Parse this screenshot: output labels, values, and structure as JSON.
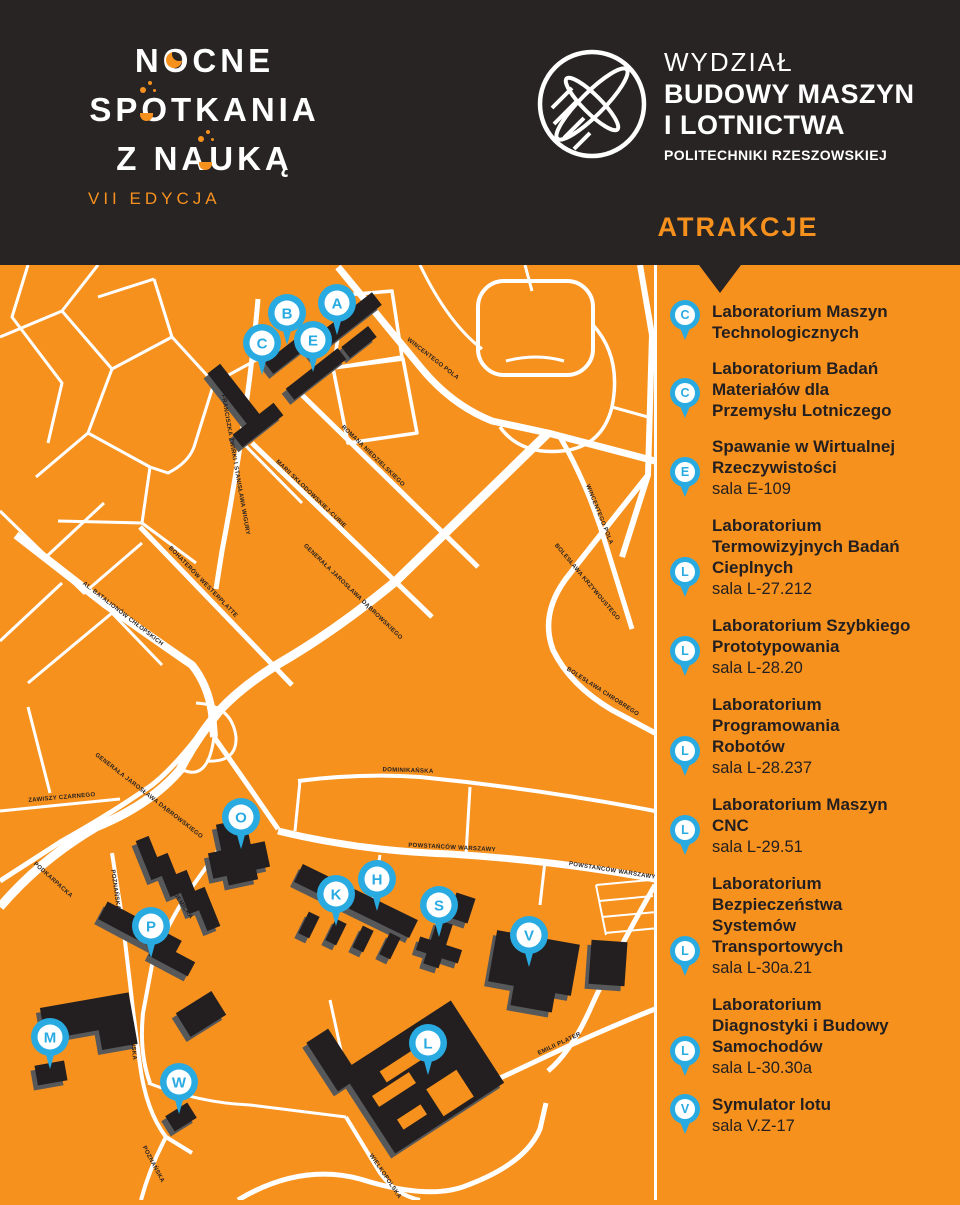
{
  "colors": {
    "orange": "#F6911E",
    "dark": "#282424",
    "ink": "#231F20",
    "blue": "#29ABE2",
    "white": "#FFFFFF",
    "building_shadow": "#57585A"
  },
  "brand": {
    "line1": "NOCNE",
    "line2": "SPOTKANIA",
    "line3": "Z NAUKĄ",
    "edition": "VII EDYCJA"
  },
  "faculty": {
    "line1": "WYDZIAŁ",
    "line2": "BUDOWY MASZYN",
    "line3": "I LOTNICTWA",
    "line4": "POLITECHNIKI RZESZOWSKIEJ"
  },
  "attractions_heading": "ATRAKCJE",
  "attractions": [
    {
      "letter": "C",
      "title": "Laboratorium Maszyn\nTechnologicznych",
      "room": ""
    },
    {
      "letter": "C",
      "title": "Laboratorium Badań\nMateriałów dla\nPrzemysłu Lotniczego",
      "room": ""
    },
    {
      "letter": "E",
      "title": "Spawanie w Wirtualnej\nRzeczywistości",
      "room": "sala E-109"
    },
    {
      "letter": "L",
      "title": "Laboratorium\nTermowizyjnych Badań\nCieplnych",
      "room": "sala L-27.212"
    },
    {
      "letter": "L",
      "title": "Laboratorium Szybkiego\nPrototypowania",
      "room": "sala L-28.20"
    },
    {
      "letter": "L",
      "title": "Laboratorium\nProgramowania\nRobotów",
      "room": "sala L-28.237"
    },
    {
      "letter": "L",
      "title": "Laboratorium Maszyn\nCNC",
      "room": "sala L-29.51"
    },
    {
      "letter": "L",
      "title": "Laboratorium\nBezpieczeństwa\nSystemów\nTransportowych",
      "room": "sala L-30a.21"
    },
    {
      "letter": "L",
      "title": "Laboratorium\nDiagnostyki i Budowy\nSamochodów",
      "room": "sala L-30.30a"
    },
    {
      "letter": "V",
      "title": "Symulator lotu",
      "room": "sala V.Z-17"
    }
  ],
  "map": {
    "pins": [
      {
        "letter": "A",
        "x": 337,
        "y": 38
      },
      {
        "letter": "B",
        "x": 287,
        "y": 48
      },
      {
        "letter": "E",
        "x": 313,
        "y": 75
      },
      {
        "letter": "C",
        "x": 262,
        "y": 78
      },
      {
        "letter": "O",
        "x": 241,
        "y": 552
      },
      {
        "letter": "H",
        "x": 377,
        "y": 614
      },
      {
        "letter": "K",
        "x": 336,
        "y": 629
      },
      {
        "letter": "S",
        "x": 439,
        "y": 640
      },
      {
        "letter": "P",
        "x": 151,
        "y": 661
      },
      {
        "letter": "V",
        "x": 529,
        "y": 670
      },
      {
        "letter": "M",
        "x": 50,
        "y": 772
      },
      {
        "letter": "L",
        "x": 428,
        "y": 778
      },
      {
        "letter": "W",
        "x": 179,
        "y": 817
      }
    ],
    "street_labels": [
      {
        "text": "WINCENTEGO POLA",
        "x": 432,
        "y": 95,
        "rot": 38
      },
      {
        "text": "WINCENTEGO POLA",
        "x": 598,
        "y": 250,
        "rot": 68
      },
      {
        "text": "ROMANA NIEDZIELSKIEGO",
        "x": 372,
        "y": 192,
        "rot": 44
      },
      {
        "text": "FRANCISZKA ŻWIRKI I STANISŁAWA WIGURY",
        "x": 234,
        "y": 200,
        "rot": 80
      },
      {
        "text": "MARII SKŁODOWSKIEJ-CURIE",
        "x": 310,
        "y": 230,
        "rot": 44
      },
      {
        "text": "GENERAŁA JAROSŁAWA DĄBROWSKIEGO",
        "x": 352,
        "y": 328,
        "rot": 44
      },
      {
        "text": "GENERAŁA JAROSŁAWA DĄBROWSKIEGO",
        "x": 148,
        "y": 532,
        "rot": 38
      },
      {
        "text": "AL. BATALIONÓW CHŁOPSKICH",
        "x": 122,
        "y": 350,
        "rot": 38
      },
      {
        "text": "BOHATERÓW WESTERPLATTE",
        "x": 202,
        "y": 318,
        "rot": 46
      },
      {
        "text": "BOLESŁAWA KRZYWOUSTEGO",
        "x": 586,
        "y": 318,
        "rot": 50
      },
      {
        "text": "BOLESŁAWA CHROBREGO",
        "x": 602,
        "y": 428,
        "rot": 33
      },
      {
        "text": "ZAWISZY CZARNEGO",
        "x": 62,
        "y": 534,
        "rot": -5
      },
      {
        "text": "PODKARPACKA",
        "x": 52,
        "y": 616,
        "rot": 42
      },
      {
        "text": "POZNAŃSKA",
        "x": 114,
        "y": 625,
        "rot": 82
      },
      {
        "text": "POZNAŃSKA",
        "x": 131,
        "y": 775,
        "rot": 84
      },
      {
        "text": "POZNAŃSKA",
        "x": 152,
        "y": 900,
        "rot": 62
      },
      {
        "text": "AKADEMICKA",
        "x": 178,
        "y": 636,
        "rot": 56
      },
      {
        "text": "POWSTAŃCÓW WARSZAWY",
        "x": 452,
        "y": 584,
        "rot": 3
      },
      {
        "text": "POWSTAŃCÓW WARSZAWY",
        "x": 612,
        "y": 607,
        "rot": 9
      },
      {
        "text": "DOMINIKAŃSKA",
        "x": 408,
        "y": 507,
        "rot": 2
      },
      {
        "text": "EMILII PLATER",
        "x": 560,
        "y": 780,
        "rot": -25
      },
      {
        "text": "WIELKOPOLSKA",
        "x": 384,
        "y": 912,
        "rot": 56
      }
    ]
  }
}
